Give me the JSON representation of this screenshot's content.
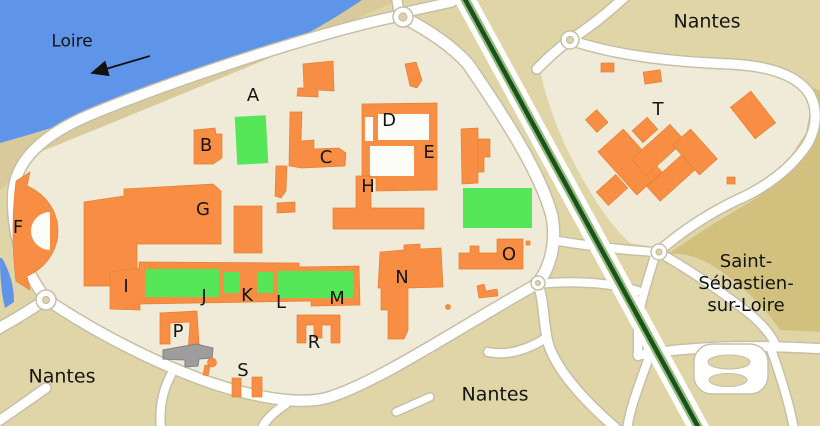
{
  "map": {
    "place_labels": [
      {
        "id": "loire",
        "text": "Loire",
        "x": 72,
        "y": 42,
        "font_size": 17
      },
      {
        "id": "nantes-top-right",
        "text": "Nantes",
        "x": 707,
        "y": 22,
        "font_size": 19
      },
      {
        "id": "saint-sebastien",
        "text": "Saint-Sébastien-\nsur-Loire",
        "x": 746,
        "y": 284,
        "font_size": 18
      },
      {
        "id": "nantes-bottom-left",
        "text": "Nantes",
        "x": 62,
        "y": 377,
        "font_size": 19
      },
      {
        "id": "nantes-bottom-center",
        "text": "Nantes",
        "x": 495,
        "y": 395,
        "font_size": 19
      }
    ],
    "building_labels": [
      {
        "letter": "A",
        "x": 253,
        "y": 96
      },
      {
        "letter": "B",
        "x": 206,
        "y": 146
      },
      {
        "letter": "C",
        "x": 326,
        "y": 158
      },
      {
        "letter": "D",
        "x": 389,
        "y": 121
      },
      {
        "letter": "E",
        "x": 429,
        "y": 153
      },
      {
        "letter": "F",
        "x": 18,
        "y": 228
      },
      {
        "letter": "G",
        "x": 203,
        "y": 210
      },
      {
        "letter": "H",
        "x": 368,
        "y": 187
      },
      {
        "letter": "I",
        "x": 126,
        "y": 287
      },
      {
        "letter": "J",
        "x": 204,
        "y": 297
      },
      {
        "letter": "K",
        "x": 247,
        "y": 296
      },
      {
        "letter": "L",
        "x": 281,
        "y": 303
      },
      {
        "letter": "M",
        "x": 337,
        "y": 299
      },
      {
        "letter": "N",
        "x": 402,
        "y": 278
      },
      {
        "letter": "O",
        "x": 509,
        "y": 255
      },
      {
        "letter": "P",
        "x": 178,
        "y": 332
      },
      {
        "letter": "R",
        "x": 314,
        "y": 343
      },
      {
        "letter": "S",
        "x": 243,
        "y": 371
      },
      {
        "letter": "T",
        "x": 658,
        "y": 110
      }
    ],
    "loire_flow_arrow": {
      "x1": 150,
      "y1": 56,
      "x2": 92,
      "y2": 73,
      "direction": "southwest"
    },
    "colors": {
      "water": "#5E95E9",
      "riverbank_sand": "#D9CA9C",
      "land": "#DFD5A7",
      "land_dark": "#D2C07E",
      "campus": "#F0EBD8",
      "building": "#F78E44",
      "special_building_gray": "#9D9D9D",
      "lawn": "#55E757",
      "road": "#FFFFFF",
      "railway": "#17541D"
    }
  }
}
